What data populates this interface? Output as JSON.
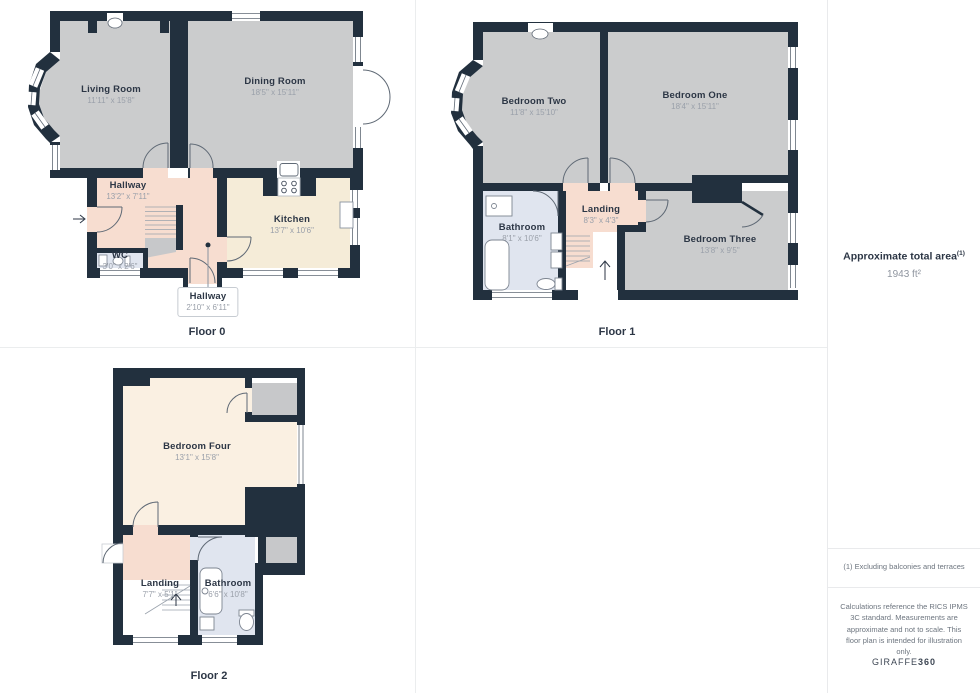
{
  "floors": [
    {
      "label": "Floor 0",
      "rooms": [
        {
          "name": "Living Room",
          "dims": "11'11\" x 15'8\""
        },
        {
          "name": "Dining Room",
          "dims": "18'5\" x 15'11\""
        },
        {
          "name": "Hallway",
          "dims": "13'2\" x 7'11\""
        },
        {
          "name": "Kitchen",
          "dims": "13'7\" x 10'6\""
        },
        {
          "name": "WC",
          "dims": "3'0\" x 2'6\""
        },
        {
          "name": "Hallway",
          "dims": "2'10\" x 6'11\""
        }
      ]
    },
    {
      "label": "Floor 1",
      "rooms": [
        {
          "name": "Bedroom Two",
          "dims": "11'8\" x 15'10\""
        },
        {
          "name": "Bedroom One",
          "dims": "18'4\" x 15'11\""
        },
        {
          "name": "Bathroom",
          "dims": "8'1\" x 10'6\""
        },
        {
          "name": "Landing",
          "dims": "8'3\" x 4'3\""
        },
        {
          "name": "Bedroom Three",
          "dims": "13'8\" x 9'5\""
        }
      ]
    },
    {
      "label": "Floor 2",
      "rooms": [
        {
          "name": "Bedroom Four",
          "dims": "13'1\" x 15'8\""
        },
        {
          "name": "Landing",
          "dims": "7'7\" x 5'1\""
        },
        {
          "name": "Bathroom",
          "dims": "6'6\" x 10'8\""
        }
      ]
    }
  ],
  "sidebar": {
    "total_area_label": "Approximate total area",
    "total_area_superscript": "(1)",
    "total_area_value": "1943 ft²",
    "footnote": "(1) Excluding balconies and terraces",
    "disclaimer": "Calculations reference the RICS IPMS 3C standard. Measurements are approximate and not to scale. This floor plan is intended for illustration only.",
    "brand": "GIRAFFE",
    "brand_bold": "360"
  },
  "colors": {
    "wall": "#22303e",
    "room_gray": "#cbcccd",
    "hall_pink": "#f7ddd0",
    "kitchen_cream": "#f5ecd8",
    "bedroom_cream": "#faf0e2",
    "bath_blue": "#e0e5ef",
    "storage_gray": "#c7c8ca"
  }
}
